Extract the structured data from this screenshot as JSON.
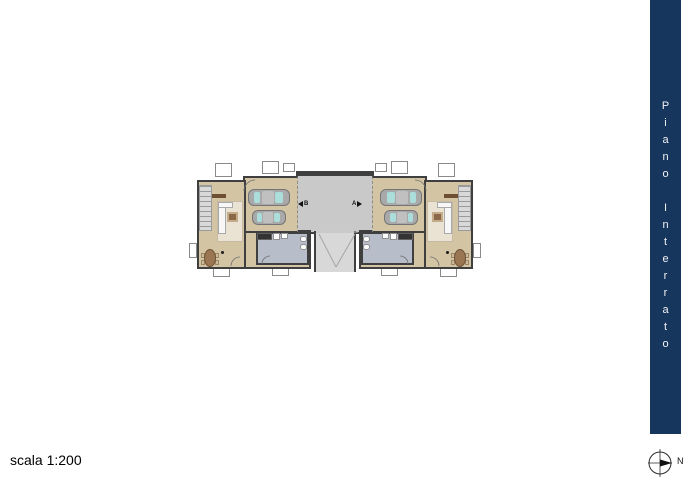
{
  "sheet": {
    "background": "#ffffff"
  },
  "title_band": {
    "title": "Piano Interrato",
    "background": "#17365e",
    "text_color": "#f2f2f2"
  },
  "scale_note": {
    "label": "scala 1:200"
  },
  "compass": {
    "label": "N",
    "icon": "compass-icon",
    "needle_direction": "right"
  },
  "floor_plan": {
    "unit_labels": {
      "left_unit": "B",
      "right_unit": "A"
    },
    "description": "Symmetric basement plan: two dwelling units (B left, A right), each with a double garage (2 cars), tavern/living room with sofa, rug, dining table, bathroom and stairs; central driveway courtyard with descending access ramp",
    "colors": {
      "wall": "#3f3f3f",
      "floor": "#d3c4a4",
      "courtyard": "#c9c9c9",
      "ramp": "#d8d8d8",
      "bathroom": "#b7bdc9",
      "rug": "#eae2d3",
      "stairs": "#d9d9d9",
      "car_body": "#a9a9a9",
      "car_glass": "#abdedb",
      "table_wood": "#9b7653"
    }
  }
}
